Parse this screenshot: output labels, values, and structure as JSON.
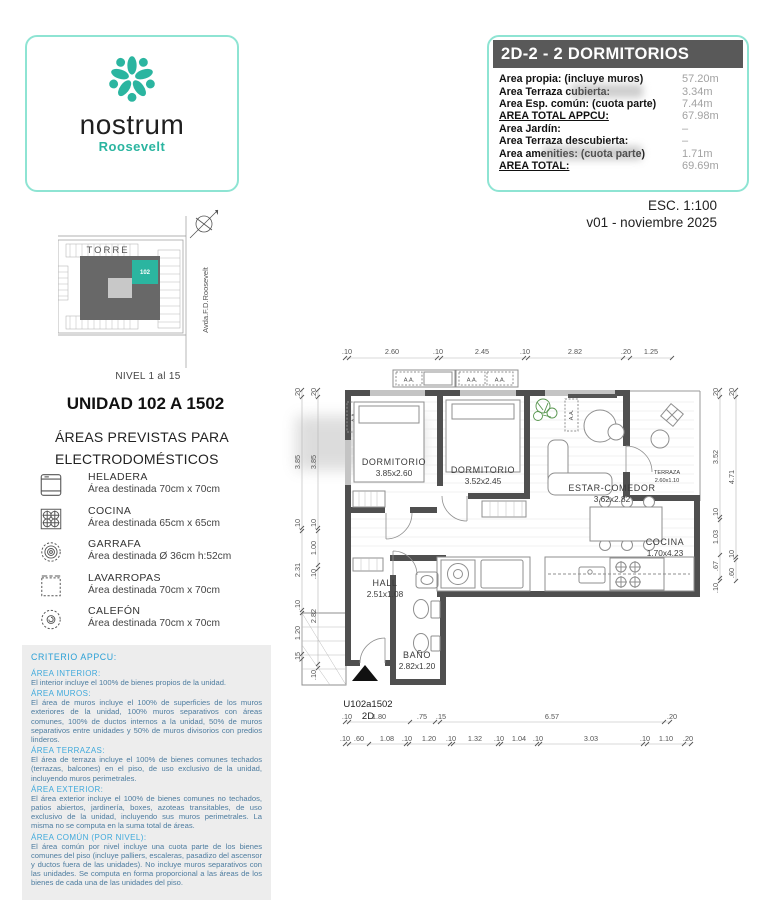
{
  "logo": {
    "name": "nostrum",
    "sub": "Roosevelt"
  },
  "header": {
    "title": "2D-2 - 2 DORMITORIOS",
    "rows": [
      {
        "label": "Area propia: (incluye muros)",
        "value": "57.20m"
      },
      {
        "label": "Area Terraza cubierta:",
        "value": "3.34m"
      },
      {
        "label": "Area Esp. común: (cuota parte)",
        "value": "7.44m"
      },
      {
        "label": "AREA TOTAL APPCU:",
        "value": "67.98m"
      },
      {
        "label": "Area Jardín:",
        "value": "–"
      },
      {
        "label": "Area Terraza descubierta:",
        "value": "–"
      },
      {
        "label": "Area amenities: (cuota parte)",
        "value": "1.71m"
      },
      {
        "label": "AREA TOTAL:",
        "value": "69.69m"
      }
    ]
  },
  "meta": {
    "scale": "ESC. 1:100",
    "version": "v01 - noviembre 2025"
  },
  "site_plan": {
    "tower_label": "TORRE",
    "unit_highlight": "102",
    "street": "Avda.F.D.Roosevelt",
    "level": "NIVEL 1 al 15"
  },
  "unit": {
    "title": "UNIDAD 102 A 1502"
  },
  "appliances": {
    "heading_line1": "ÁREAS PREVISTAS PARA",
    "heading_line2": "ELECTRODOMÉSTICOS",
    "items": [
      {
        "name": "HELADERA",
        "desc": "Área destinada 70cm x 70cm",
        "icon": "fridge-icon"
      },
      {
        "name": "COCINA",
        "desc": "Área destinada 65cm x 65cm",
        "icon": "stove-icon"
      },
      {
        "name": "GARRAFA",
        "desc": "Área destinada Ø 36cm h:52cm",
        "icon": "gas-cylinder-icon"
      },
      {
        "name": "LAVARROPAS",
        "desc": "Área destinada 70cm x 70cm",
        "icon": "washer-icon"
      },
      {
        "name": "CALEFÓN",
        "desc": "Área destinada 70cm x 70cm",
        "icon": "water-heater-icon"
      }
    ]
  },
  "criteria": {
    "title": "CRITERIO APPCU:",
    "sections": [
      {
        "heading": "ÁREA INTERIOR:",
        "body": "El interior incluye el 100% de bienes propios de la unidad."
      },
      {
        "heading": "ÁREA MUROS:",
        "body": "El área de muros incluye el 100% de superficies de los muros exteriores de la unidad, 100% muros separativos con áreas comunes, 100% de ductos internos a la unidad, 50% de muros separativos entre unidades y 50% de muros divisorios con predios linderos."
      },
      {
        "heading": "ÁREA TERRAZAS:",
        "body": "El área de terraza incluye el 100% de bienes comunes techados (terrazas, balcones) en el piso, de uso exclusivo de la unidad, incluyendo muros perimetrales."
      },
      {
        "heading": "ÁREA EXTERIOR:",
        "body": "El área exterior incluye el 100% de bienes comunes no techados, patios abiertos, jardinería, boxes, azoteas transitables, de uso exclusivo de la unidad, incluyendo sus muros perimetrales. La misma no se computa en la suma total de áreas."
      },
      {
        "heading": "ÁREA COMÚN (POR NIVEL):",
        "body": "El área común por nivel incluye una cuota parte de los bienes comunes del piso (incluye palliers, escaleras, pasadizo del ascensor y ductos fuera de las unidades). No incluye muros separativos con las unidades. Se computa en forma proporcional a las áreas de los bienes de cada una de las unidades del piso."
      }
    ]
  },
  "floor_plan": {
    "unit_label": "U102a1502",
    "unit_type": "2D",
    "ac_label": "A.A.",
    "rooms": [
      {
        "name": "DORMITORIO",
        "size": "3.85x2.60"
      },
      {
        "name": "DORMITORIO",
        "size": "3.52x2.45"
      },
      {
        "name": "ESTAR-COMEDOR",
        "size": "3.62x2.82"
      },
      {
        "name": "TERRAZA",
        "size": "2.60x1.10"
      },
      {
        "name": "COCINA",
        "size": "1.70x4.23"
      },
      {
        "name": "HALL",
        "size": "2.51x1.08"
      },
      {
        "name": "BAÑO",
        "size": "2.82x1.20"
      }
    ],
    "dims_top": [
      ".10",
      "2.60",
      ".10",
      "2.45",
      ".10",
      "2.82",
      ".20",
      "1.25"
    ],
    "dims_left_outer": [
      ".20",
      "3.85",
      ".10",
      "2.31",
      ".10",
      "1.20",
      ".15"
    ],
    "dims_left_inner": [
      ".20",
      "3.85",
      ".10",
      "1.00",
      ".10",
      "2.82",
      ".10"
    ],
    "dims_right_inner": [
      ".20",
      "3.52",
      ".10",
      "1.03",
      ".67",
      ".10"
    ],
    "dims_right_outer": [
      ".20",
      "4.71",
      ".10",
      ".60"
    ],
    "dims_bottom_inner": [
      ".10",
      "1.80",
      ".75",
      ".15",
      "6.57",
      ".20"
    ],
    "dims_bottom_outer": [
      ".10",
      ".60",
      "1.08",
      ".10",
      "1.20",
      ".10",
      "1.32",
      ".10",
      "1.04",
      ".10",
      "3.03",
      ".10",
      "1.10",
      ".20"
    ]
  },
  "colors": {
    "accent_teal": "#2bb5a0",
    "border_teal": "#8ee4d3",
    "header_bar": "#595959",
    "value_gray": "#a2a2a2",
    "criteria_heading": "#41aadc",
    "criteria_body": "#4e7da0",
    "wall_gray": "#4f4f4f"
  }
}
